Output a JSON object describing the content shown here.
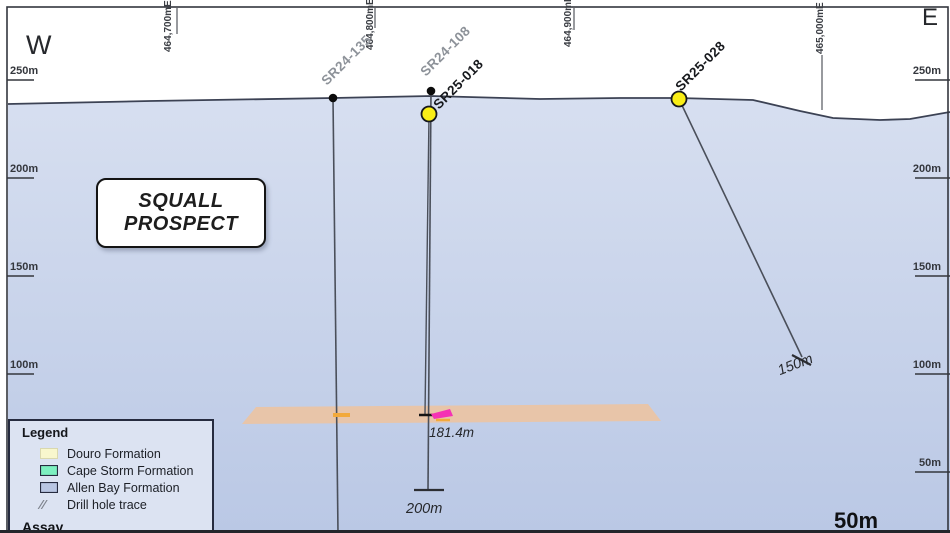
{
  "direction_labels": {
    "west": "W",
    "east": "E"
  },
  "easting_labels": [
    "464,700mE",
    "464,800mE",
    "464,900mE",
    "465,000mE"
  ],
  "elevation_labels": {
    "left": [
      "250m",
      "200m",
      "150m",
      "100m"
    ],
    "right": [
      "250m",
      "200m",
      "150m",
      "100m",
      "50m"
    ]
  },
  "prospect": {
    "line1": "SQUALL",
    "line2": "PROSPECT"
  },
  "drill_holes": [
    {
      "id": "SR24-135",
      "label_color": "#8d9299",
      "collar": "black-dot"
    },
    {
      "id": "SR24-108",
      "label_color": "#8d9299",
      "collar": "black-dot"
    },
    {
      "id": "SR25-018",
      "label_color": "#17191d",
      "collar": "yellow-circle"
    },
    {
      "id": "SR25-028",
      "label_color": "#17191d",
      "collar": "yellow-circle"
    }
  ],
  "annotations": {
    "assay_depth": "181.4m",
    "end_of_hole_200": "200m",
    "end_of_hole_150": "150m"
  },
  "scale_label": "50m",
  "legend": {
    "title": "Legend",
    "items": [
      {
        "label": "Douro Formation",
        "swatch": "#f8f7cd"
      },
      {
        "label": "Cape Storm Formation",
        "swatch": "#7df0c0"
      },
      {
        "label": "Allen Bay Formation",
        "swatch": "#b9c6e3"
      },
      {
        "label": "Drill hole trace",
        "swatch": "slashes"
      }
    ],
    "assay_heading": "Assay"
  },
  "colors": {
    "sky": "#ffffff",
    "allen_bay_top": "#d7dff0",
    "allen_bay_bottom": "#bac8e5",
    "surface_line": "#3c4254",
    "assay_band": "#e8c5a9",
    "marker_orange": "#f2a93b",
    "marker_pink": "#f531b4",
    "collar_yellow": "#f9ee16",
    "trace": "#4a4f5a",
    "frame": "#33363e"
  }
}
